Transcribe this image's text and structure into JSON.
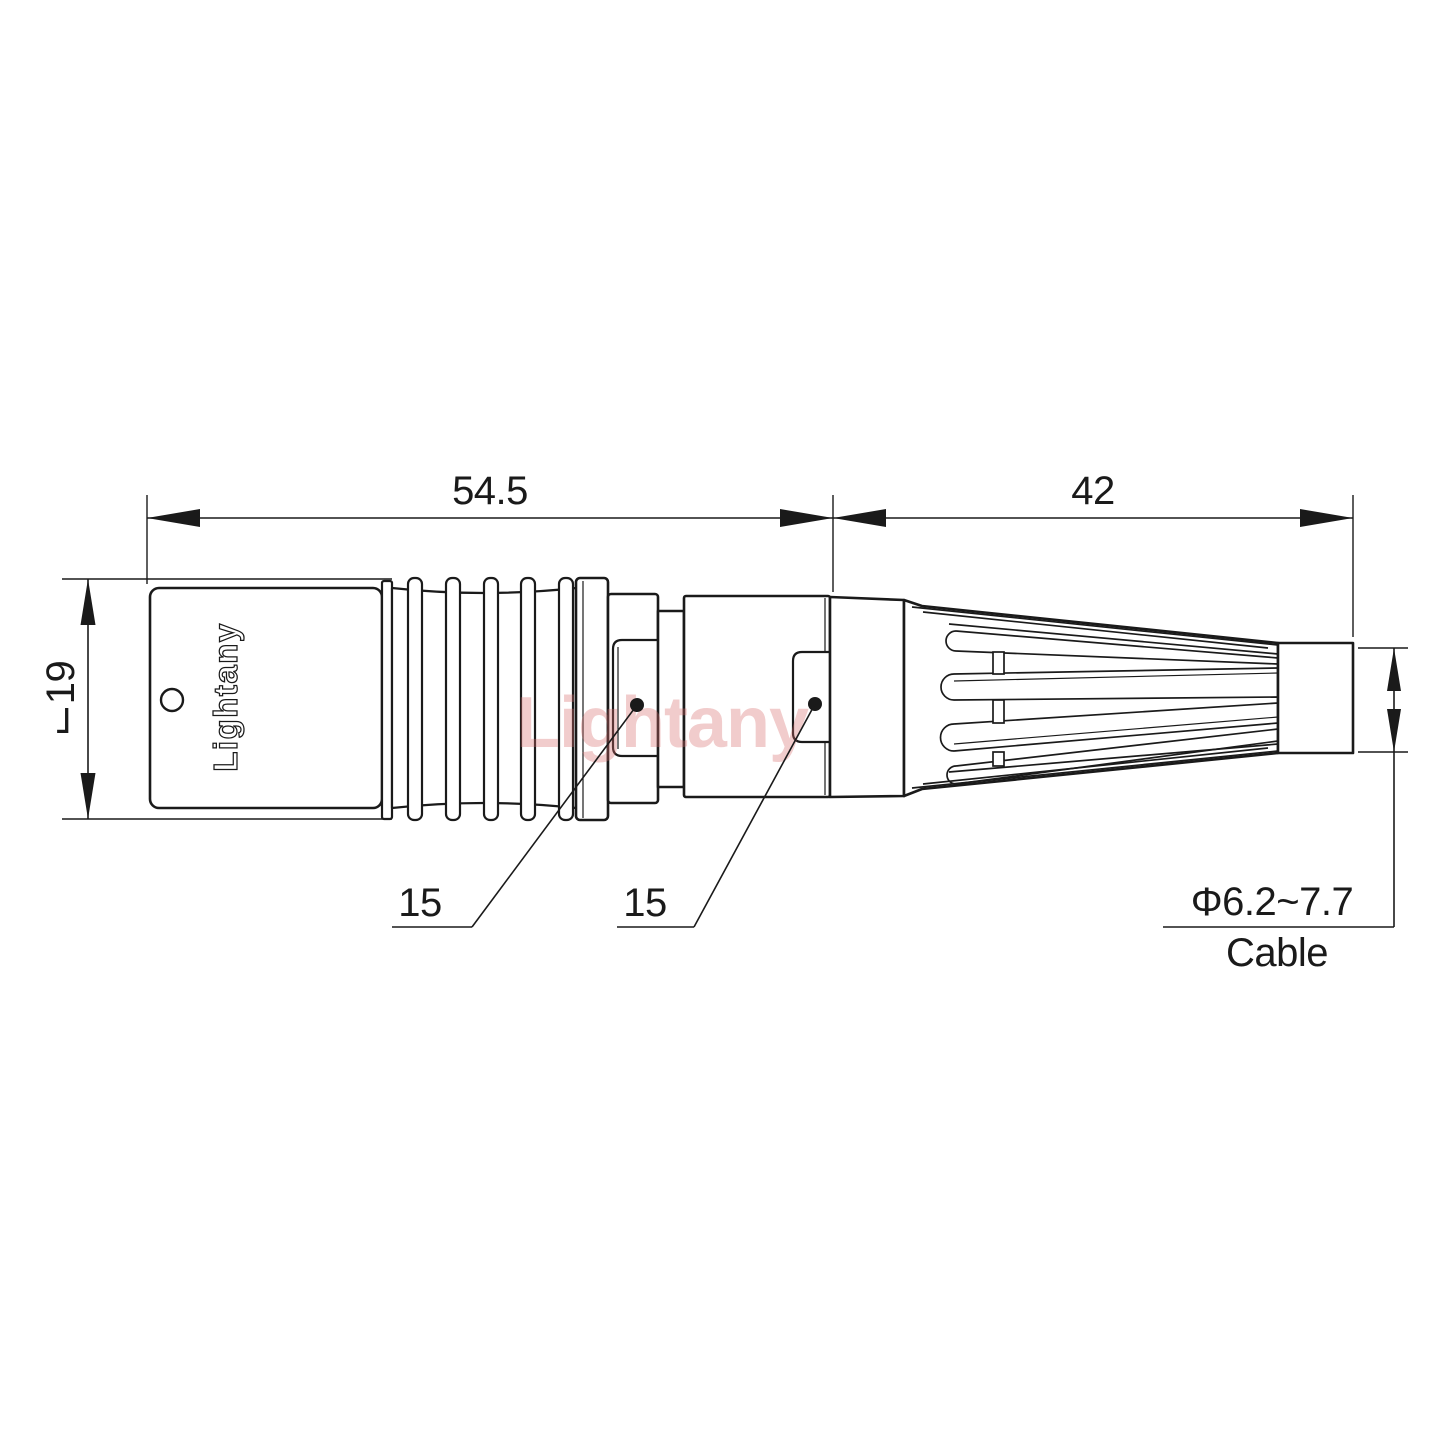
{
  "page": {
    "background": "#ffffff",
    "description": "Technical dimension drawing of a circular push-pull cable connector"
  },
  "dimensions": {
    "front_length": "54.5",
    "back_length": "42",
    "body_diameter": "⌙19",
    "collar_size": "15",
    "nut_size": "15",
    "cable_diameter": "Φ6.2~7.7",
    "cable_word": "Cable"
  },
  "branding": {
    "body_label": "Lightany",
    "watermark": "Lightany"
  },
  "colors": {
    "line": "#1a1a1a",
    "watermark": "#d96c6c"
  }
}
